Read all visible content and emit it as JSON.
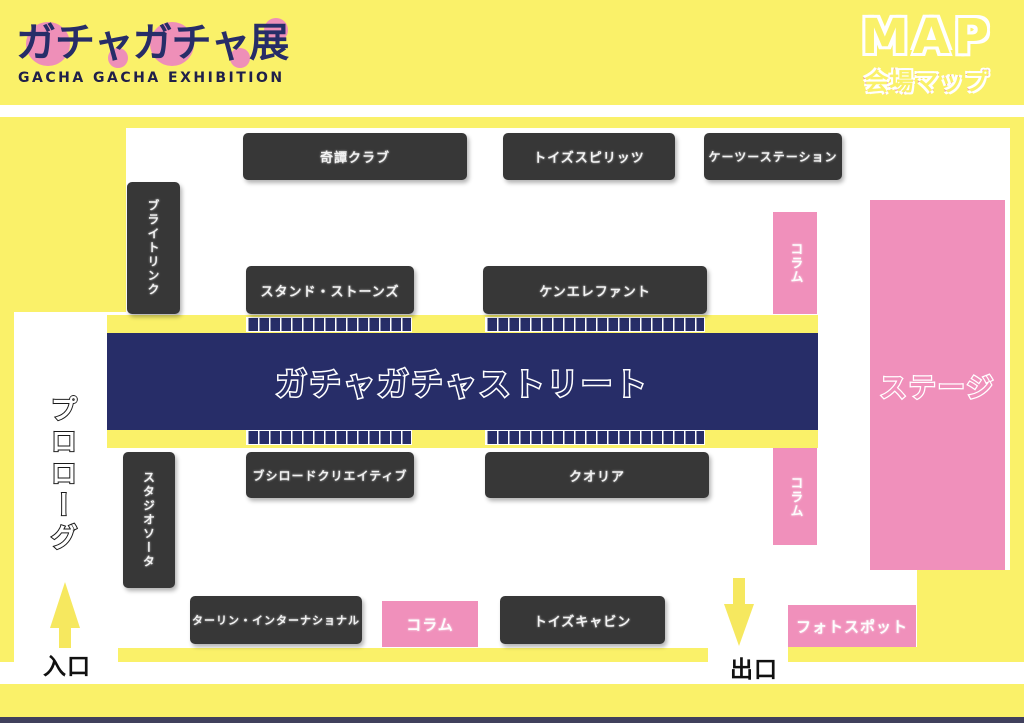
{
  "header": {
    "logo_title": "ガチャガチャ展",
    "logo_subtitle": "GACHA GACHA EXHIBITION",
    "map_title": "MAP",
    "map_subtitle": "会場マップ"
  },
  "street": {
    "label": "ガチャガチャストリート"
  },
  "booths": {
    "kitan_club": "奇譚クラブ",
    "toys_spirits": "トイズスピリッツ",
    "k2_station": "ケーツーステーション",
    "bright_link": "ブライトリンク",
    "stand_stones": "スタンド・ストーンズ",
    "ken_elephant": "ケンエレファント",
    "bushiroad_creative": "ブシロードクリエイティブ",
    "qualia": "クオリア",
    "studio_sota": "スタジオソータ",
    "tarlin_international": "ターリン・インターナショナル",
    "toys_cabin": "トイズキャビン"
  },
  "areas": {
    "stage": "ステージ",
    "column": "コラム",
    "photo_spot": "フォトスポット"
  },
  "navigation": {
    "prologue": "プロローグ",
    "entrance": "入口",
    "exit": "出口"
  },
  "colors": {
    "background_yellow": "#FAF169",
    "accent_pink": "#F090BB",
    "street_navy": "#272D68",
    "booth_dark": "#373737"
  }
}
